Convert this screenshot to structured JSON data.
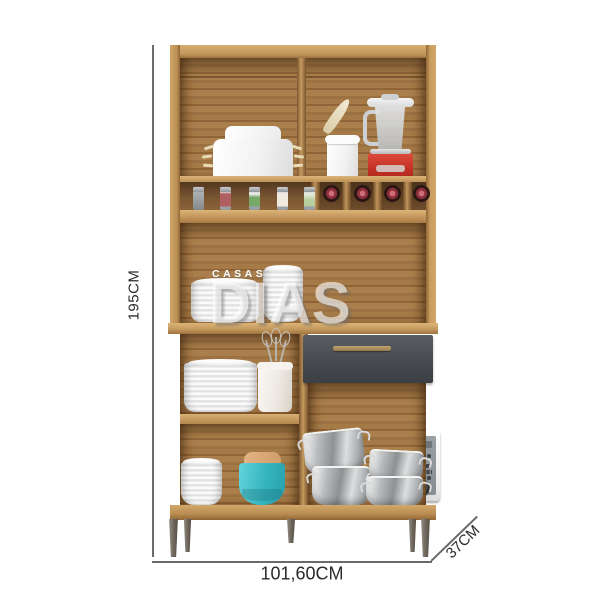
{
  "watermark": {
    "line1": "CASAS",
    "line2": "DIAS"
  },
  "dimensions": {
    "height_label": "195CM",
    "width_label": "101,60CM",
    "depth_label": "37CM"
  },
  "colors": {
    "background": "#ffffff",
    "wood_frame": "#c89c61",
    "wood_back_panel": "#a3774a",
    "wood_dark_shadow": "#6e4c26",
    "drawer_front": "#494d52",
    "drawer_handle_bronze": "#ab8c5d",
    "microwave_door_grey": "#949b9f",
    "blender_red": "#c6362b",
    "teal_bowl": "#3bb9c4",
    "tan_bowl": "#d8a877",
    "steel_pot": "#b9bcbe",
    "leg_grey": "#7d756c",
    "dimension_line": "#6a6a6a",
    "dimension_text": "#2b2b2b",
    "wine_cap_red": "#c2606c"
  }
}
